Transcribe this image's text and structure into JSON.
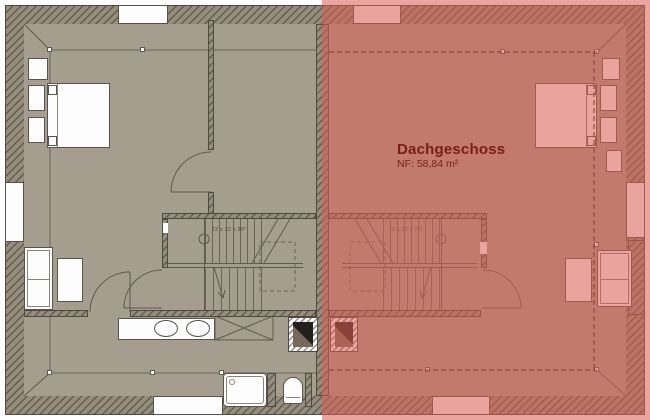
{
  "title": {
    "text": "Dachgeschoss",
    "area": "NF: 58,84 m²"
  },
  "stairs": {
    "left": {
      "label": "12 x 22 x 20°"
    },
    "right": {
      "label": "12 x 22 x 20°"
    }
  },
  "colors": {
    "floor_beige": "#a59d8e",
    "wall_base": "#968e7c",
    "line_dark": "#5f5a50",
    "highlight_red": "#d85e52",
    "highlight_furniture_pink": "#f3b9b3",
    "title_text_red": "#7a1e14",
    "knee_line_right_red": "#8d3a2f"
  }
}
